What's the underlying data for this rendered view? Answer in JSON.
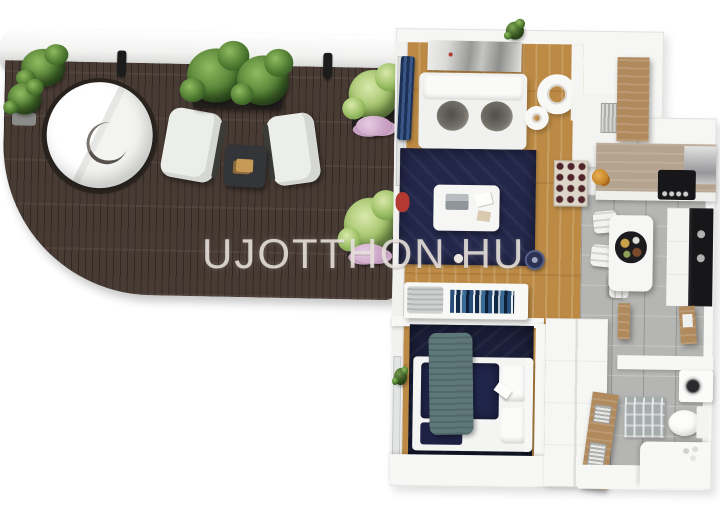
{
  "watermark": {
    "brand_left": "UJOTTHON",
    "brand_right": "HU",
    "separator_dots": 3
  },
  "colors": {
    "deck": "#483b34",
    "wood_floor": "#bc8a44",
    "tile": "#b5b6b4",
    "rug_navy": "#232749",
    "bed_navy": "#1a1e38",
    "blanket_teal": "#5e7879",
    "wall_white": "#f6f6f5",
    "counter_wood": "#b4a38e",
    "cabinet_wood": "#b08a5c",
    "appliance_black": "#17171a",
    "plant_green": "#4e7a30",
    "plant_light_green": "#9fc268",
    "flower_pink": "#c79ec2",
    "curtain_navy": "#3a5687",
    "accent_red": "#b33a31",
    "watermark": "rgba(236,230,224,0.85)"
  },
  "scene": {
    "view": "top-down 3D apartment floor plan render",
    "rooms": [
      {
        "name": "terrace"
      },
      {
        "name": "living-room"
      },
      {
        "name": "bedroom"
      },
      {
        "name": "kitchen-dining"
      },
      {
        "name": "bathroom"
      }
    ],
    "objects": [
      "round-daybed",
      "armchair-left",
      "armchair-right",
      "terrace-side-table",
      "railing",
      "wall-lamps",
      "potted-plants",
      "flowering-plants",
      "sofa",
      "wall-art",
      "pendant-lamp",
      "navy-area-rug",
      "coffee-table",
      "laptop",
      "curtain",
      "robot-vacuum",
      "sideboard-with-books",
      "double-bed",
      "teal-blanket",
      "pillows",
      "slippers",
      "wardrobe",
      "open-wood-door",
      "kitchen-counter",
      "wine-rack",
      "cooktop",
      "extractor-hood",
      "oven-column",
      "dining-table",
      "dining-chairs",
      "food-tray",
      "toilet",
      "washing-machine",
      "bath-mat",
      "bath-counter"
    ]
  }
}
